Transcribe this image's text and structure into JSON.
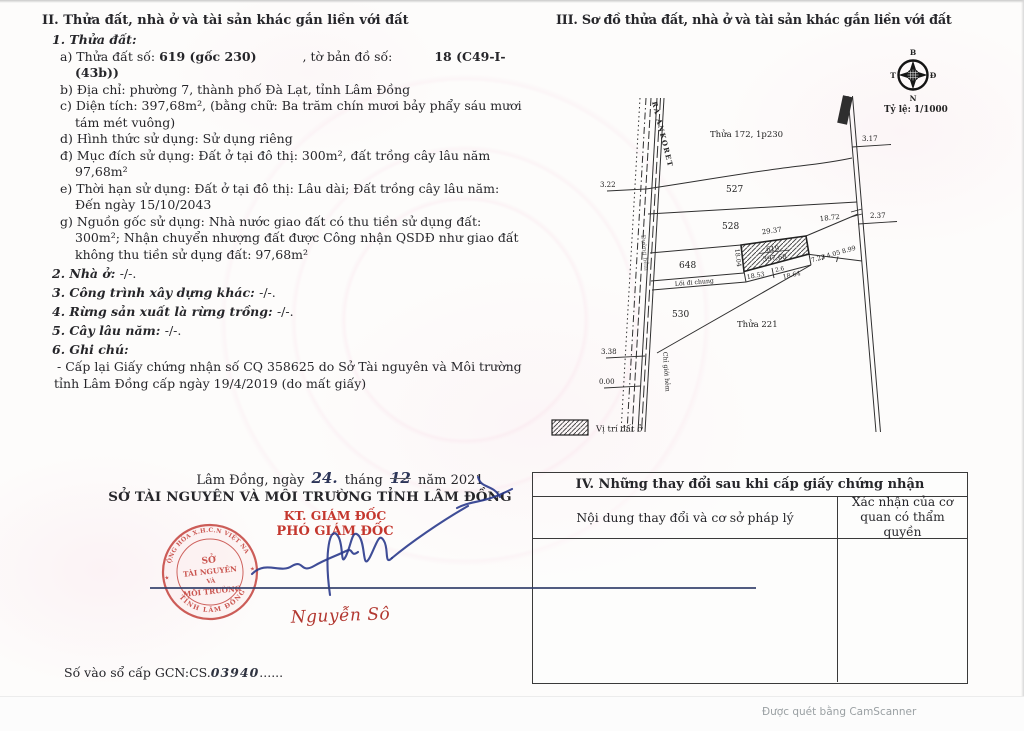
{
  "section2": {
    "heading": "II. Thửa đất, nhà ở và tài sản khác gắn liền với đất",
    "sub1": "1. Thửa đất:",
    "a_label": "a) Thửa đất số:",
    "a_value": "619 (gốc 230)",
    "a_label2": ", tờ bản đồ số:",
    "a_value2": "18 (C49-I-(43b))",
    "b_line": "b) Địa chỉ:  phường 7, thành phố Đà Lạt, tỉnh Lâm Đồng",
    "c_line": "c) Diện tích: 397,68m², (bằng chữ: Ba trăm chín mươi bảy phẩy sáu mươi tám mét vuông)",
    "d_line": "d) Hình thức sử dụng:  Sử dụng riêng",
    "dd_line": "đ) Mục đích sử dụng:  Đất ở tại đô thị: 300m², đất trồng cây lâu năm 97,68m²",
    "e_line": "e) Thời hạn sử dụng:  Đất ở tại đô thị: Lâu dài; Đất trồng cây lâu năm: Đến ngày 15/10/2043",
    "g_line": "g) Nguồn gốc sử dụng: Nhà nước giao đất có thu tiền sử dụng đất: 300m²; Nhận chuyển nhượng đất được Công nhận QSDĐ như giao đất không thu tiền sử dụng đất: 97,68m²",
    "sub2_label": "2. Nhà ở:",
    "sub2_value": "-/-.",
    "sub3_label": "3. Công trình xây dựng khác:",
    "sub3_value": "-/-.",
    "sub4_label": "4. Rừng sản xuất là rừng trồng:",
    "sub4_value": "-/-.",
    "sub5_label": "5. Cây lâu năm:",
    "sub5_value": "-/-.",
    "sub6_label": "6. Ghi chú:",
    "sub6_note": "- Cấp lại Giấy chứng nhận số CQ 358625 do Sở Tài nguyên và Môi trường tỉnh Lâm Đồng cấp ngày 19/4/2019 (do mất giấy)"
  },
  "section3": {
    "heading": "III. Sơ đồ thửa đất, nhà ở và tài sản khác gắn liền với đất",
    "scale": "Tỷ lệ: 1/1000",
    "compass": {
      "north": "B",
      "east": "Đ",
      "south": "N",
      "west": "T"
    },
    "legend_label": "Vị trí đất ở",
    "map": {
      "thua172": "Thửa 172, 1p230",
      "p527": "527",
      "p528": "528",
      "p648": "648",
      "p530": "530",
      "thua221": "Thửa 221",
      "p619_no": "619",
      "p619_area": "397,68",
      "road_left_name": "RA ANKORET",
      "road_left_side": "Đường hẻm",
      "boundary_note": "Chỉ giới hẻm",
      "path_label": "Lối đi chung",
      "dims": {
        "top": "29.37",
        "right_top": "18.72",
        "left": "18.04",
        "bottom_left": "18.53",
        "bottom_mid": "2.6",
        "bottom": "18.64",
        "slope": "7.23 4.05 8.99",
        "left_t1": "3.22",
        "left_t2": "3.38",
        "left_t3": "0.00",
        "right_t1": "3.17",
        "right_t2": "2.37"
      }
    }
  },
  "signing": {
    "place_label": "Lâm Đồng, ngày",
    "day": "24.",
    "month_label": "tháng",
    "month": "12",
    "year_label": "năm 2021",
    "org": "SỞ TÀI NGUYÊN VÀ MÔI TRƯỜNG TỈNH LÂM ĐỒNG",
    "title1": "KT. GIÁM ĐỐC",
    "title2": "PHÓ GIÁM ĐỐC",
    "signer": "Nguyễn Sô",
    "stamp": {
      "arc_top": "CỘNG HÒA X.H.C.N VIỆT NAM",
      "arc_bottom": "TỈNH LÂM ĐỒNG",
      "line1": "SỞ",
      "line2": "TÀI NGUYÊN",
      "line3": "VÀ",
      "line4": "MÔI TRƯỜNG",
      "star": "★"
    }
  },
  "table4": {
    "title": "IV. Những thay đổi sau khi cấp giấy chứng nhận",
    "col1": "Nội dung thay đổi và cơ sở pháp lý",
    "col2": "Xác nhận của cơ quan có thẩm quyền"
  },
  "footer": {
    "gcn_label": "Số vào sổ cấp GCN:CS.",
    "gcn_value": "03940",
    "gcn_dots": "......",
    "scanner": "Được quét bằng CamScanner"
  }
}
